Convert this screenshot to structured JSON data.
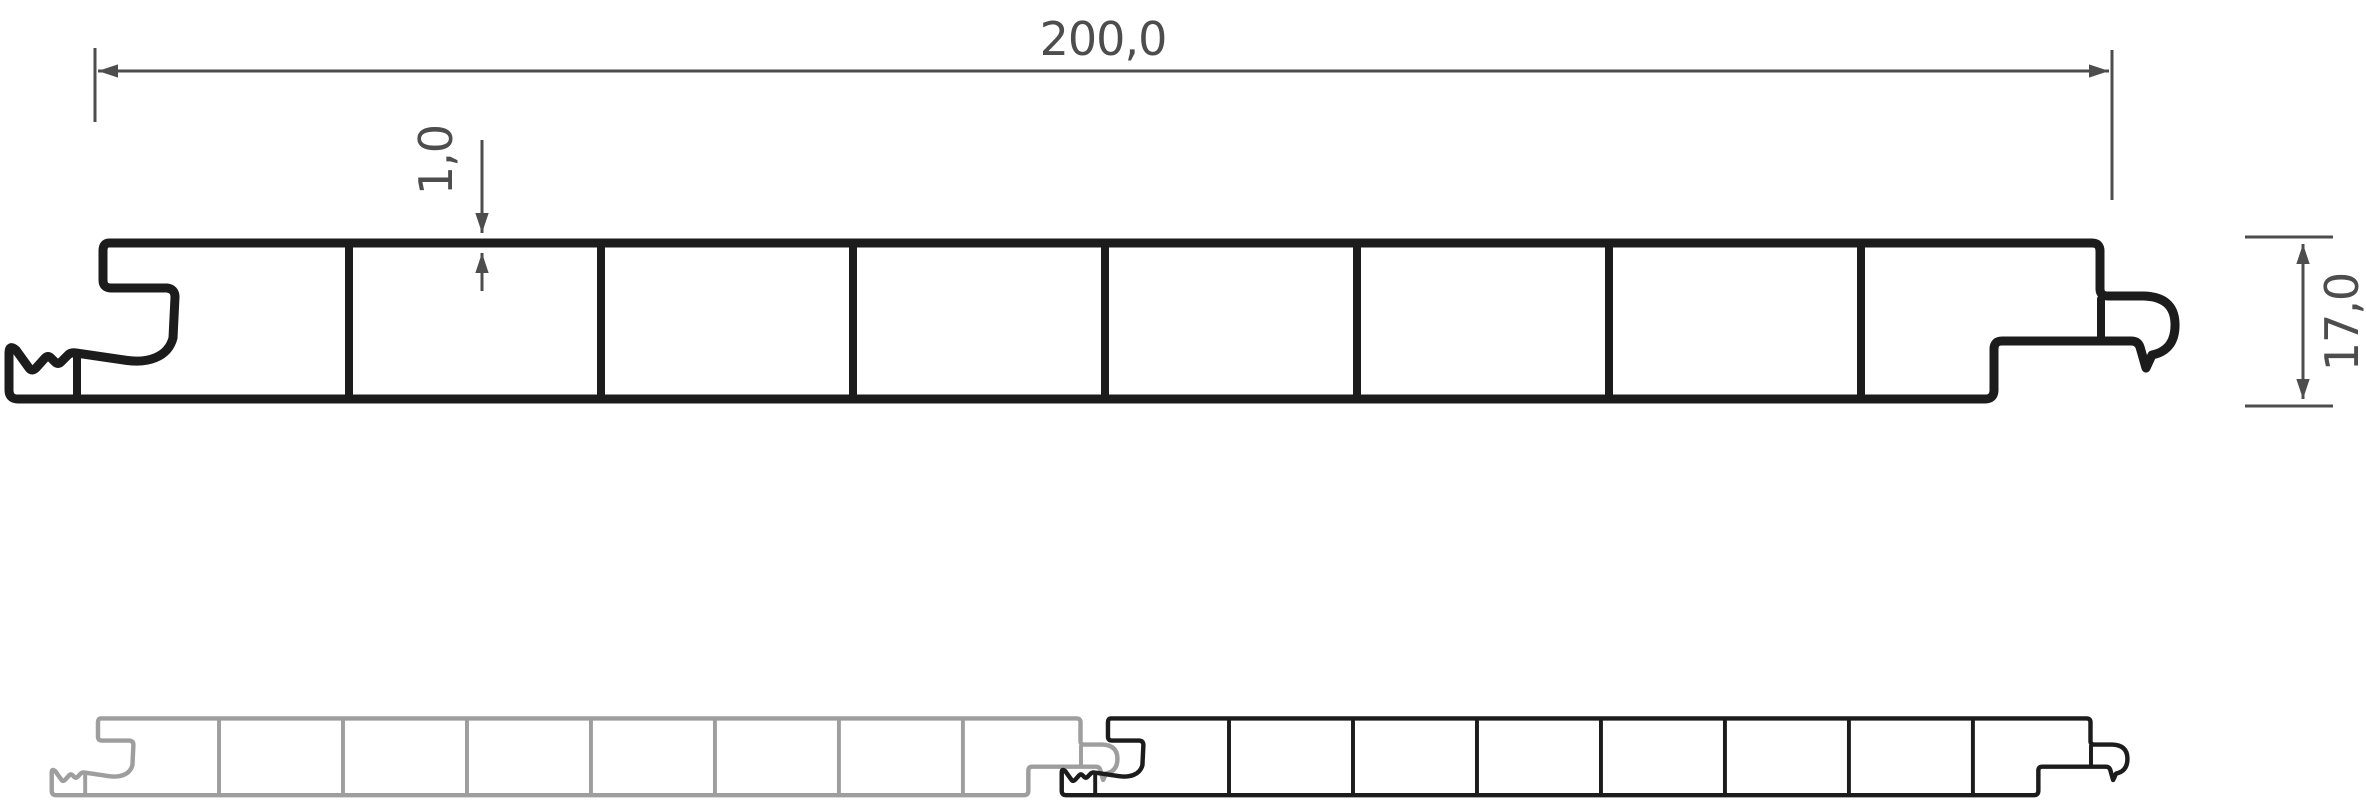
{
  "drawing": {
    "kind": "hollow-chamber panel profile cross-section",
    "colors": {
      "background": "#ffffff",
      "profile": "#1c1c1c",
      "panel_gray": "#9e9e9e",
      "dimension": "#4d4d4d"
    },
    "dimensions": {
      "width": {
        "label": "200,0"
      },
      "wall_thickness": {
        "label": "1,0"
      },
      "height": {
        "label": "17,0"
      }
    },
    "profile": {
      "chambers": 8,
      "webs": 7
    },
    "assembly": {
      "panels": 2
    }
  }
}
